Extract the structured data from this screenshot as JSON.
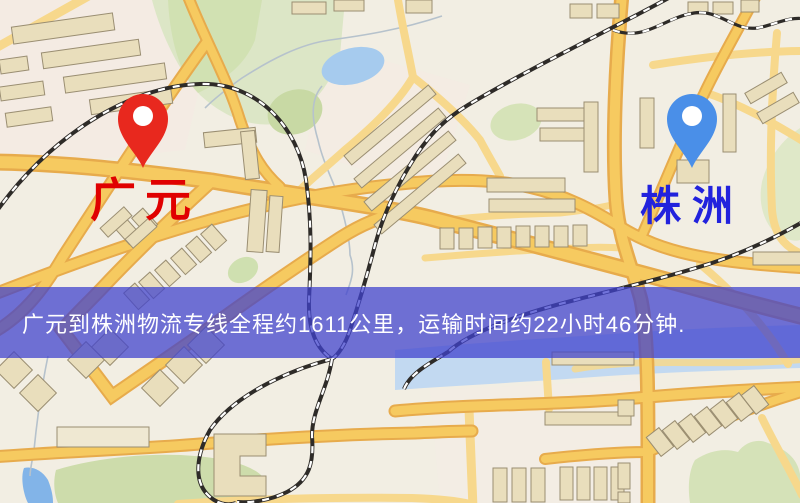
{
  "map": {
    "origin": {
      "label": "广元",
      "pin_color": "#e8281e",
      "label_color": "#e00000"
    },
    "destination": {
      "label": "株洲",
      "pin_color": "#4a8fe8",
      "label_color": "#2222dd"
    },
    "banner": {
      "text": "广元到株洲物流专线全程约1611公里，运输时间约22小时46分钟.",
      "background_color": "#4042cd",
      "text_color": "#ffffff"
    },
    "route": {
      "distance_km": "1611",
      "duration": "22小时46分钟"
    },
    "colors": {
      "map_background": "#f2eee3",
      "road_fill": "#f6ca60",
      "road_casing": "#e7ab4c",
      "railway": "#2e2b28",
      "water": "#a6cbee",
      "park_green": "#cfdfae",
      "building": "#e9debc"
    }
  }
}
